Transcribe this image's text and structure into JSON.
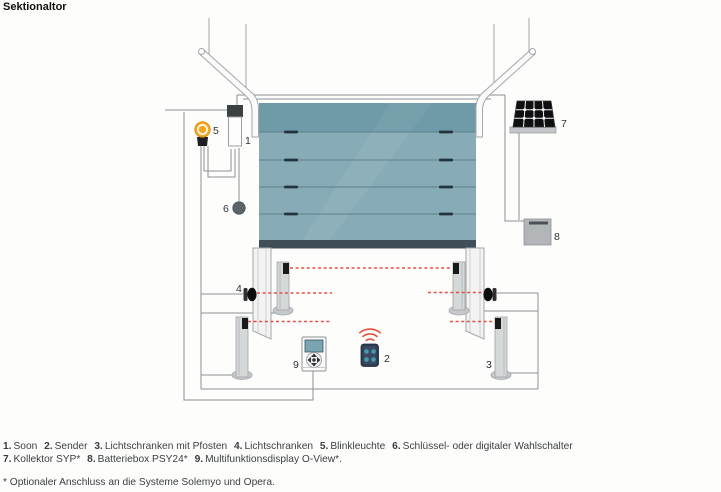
{
  "title": "Sektionaltor",
  "figure": {
    "labels": {
      "soon_drive": "1",
      "sender": "2",
      "photocell_post": "3",
      "photocell": "4",
      "flashing_light": "5",
      "key_switch": "6",
      "collector": "7",
      "battery_box": "8",
      "display": "9"
    },
    "colors": {
      "door_panel": "#87acb8",
      "door_top_panel": "#6f9aa8",
      "door_bottom_bar": "#3f4e57",
      "beam_red": "#e0504a",
      "signal_red": "#e8503c",
      "blinker_orange": "#f6a41c",
      "remote_body": "#2e3d52",
      "remote_buttons": "#4899ad",
      "wire_gray": "#8a9094"
    }
  },
  "caption": {
    "line1": [
      {
        "num": "1.",
        "label": "Soon"
      },
      {
        "num": "2.",
        "label": "Sender"
      },
      {
        "num": "3.",
        "label": "Lichtschranken mit Pfosten"
      },
      {
        "num": "4.",
        "label": "Lichtschranken"
      },
      {
        "num": "5.",
        "label": "Blinkleuchte"
      },
      {
        "num": "6.",
        "label": "Schlüssel- oder digitaler Wahlschalter"
      }
    ],
    "line2": [
      {
        "num": "7.",
        "label": "Kollektor SYP*"
      },
      {
        "num": "8.",
        "label": "Batteriebox PSY24*"
      },
      {
        "num": "9.",
        "label": "Multifunktionsdisplay O-View*."
      }
    ],
    "footnote": "* Optionaler Anschluss an die Systeme Solemyo und Opera."
  }
}
